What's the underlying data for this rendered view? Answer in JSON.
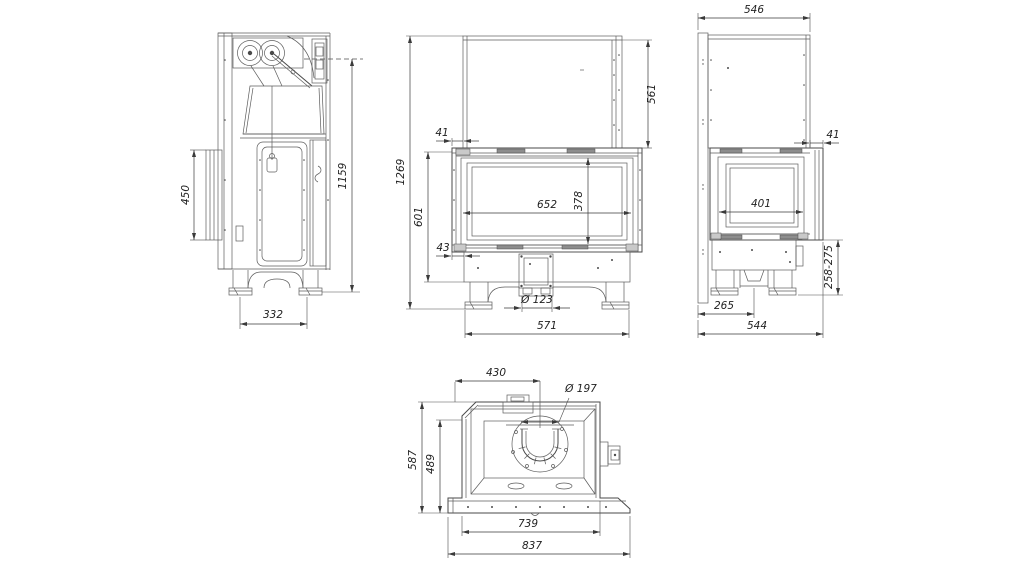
{
  "drawing": {
    "background": "#ffffff",
    "line_color": "#4a4a4a",
    "dimension_color": "#222222",
    "views": {
      "side_left": {
        "dims": {
          "frame_height": "450",
          "overall_height": "1159",
          "base_depth": "332"
        }
      },
      "front": {
        "dims": {
          "overall_height": "1269",
          "body_height": "601",
          "top_offset": "41",
          "bottom_offset": "43",
          "hood_height": "561",
          "glass_width": "652",
          "glass_height": "378",
          "air_inlet_diameter": "Ø 123",
          "base_width": "571"
        }
      },
      "side_right": {
        "dims": {
          "top_depth": "546",
          "front_offset": "41",
          "glass_width": "401",
          "base_height_range": "258-275",
          "flue_offset": "265",
          "overall_depth": "544"
        }
      },
      "plan": {
        "dims": {
          "flue_center_offset": "430",
          "flue_diameter": "Ø 197",
          "inner_depth": "489",
          "overall_depth": "587",
          "body_width": "739",
          "overall_width": "837"
        }
      }
    }
  }
}
